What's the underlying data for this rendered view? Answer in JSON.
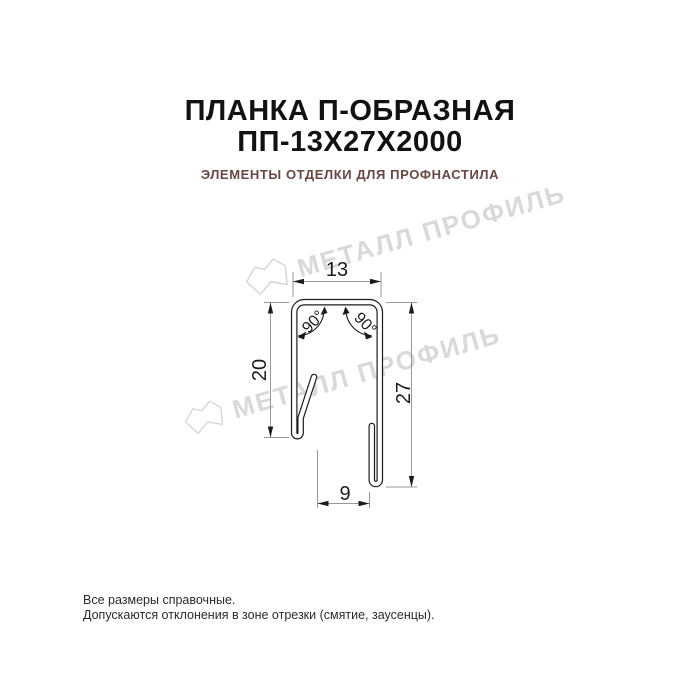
{
  "header": {
    "title_line1": "ПЛАНКА П-ОБРАЗНАЯ",
    "title_line2": "ПП-13Х27Х2000",
    "subtitle": "ЭЛЕМЕНТЫ ОТДЕЛКИ ДЛЯ ПРОФНАСТИЛА"
  },
  "drawing": {
    "type": "technical-profile-cross-section",
    "product": "U-shaped strip (планка П-образная)",
    "dimensions": {
      "top_width": "13",
      "left_height": "20",
      "right_height": "27",
      "bottom_width": "9",
      "angle_left": "90°",
      "angle_right": "90°"
    }
  },
  "watermark": {
    "text": "МЕТАЛЛ ПРОФИЛЬ",
    "logo": "metall-profil-logo"
  },
  "footer": {
    "line1": "Все размеры справочные.",
    "line2": "Допускаются отклонения в зоне отрезки (смятие, заусенцы)."
  },
  "colors": {
    "title": "#121212",
    "subtitle": "#684742",
    "drawing_lines": "#1c1c1c",
    "dimension_lines": "#999999",
    "watermark": "#d9d9d9",
    "background": "#ffffff"
  }
}
